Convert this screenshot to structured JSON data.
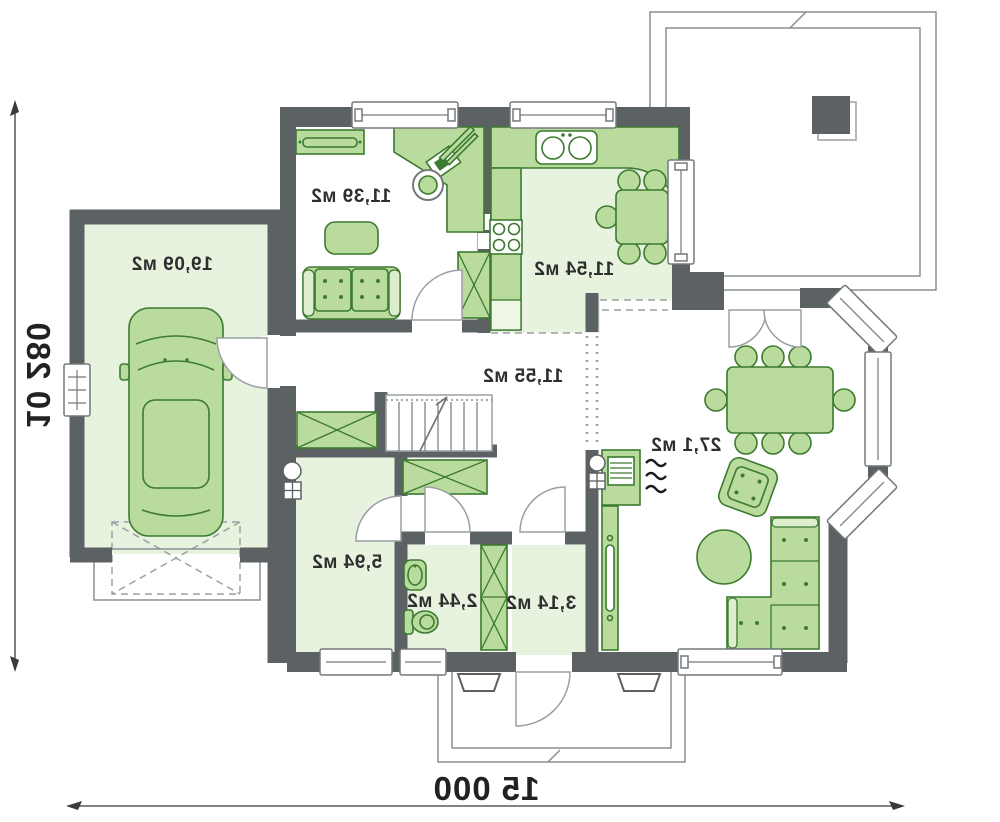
{
  "plan_type": "house-first-floor-plan",
  "note": "plan rendered mirrored (flipped horizontally), labels appear reversed",
  "rooms": [
    {
      "id": "garage",
      "area_label": "19,09 м2"
    },
    {
      "id": "office",
      "area_label": "11,39 м2"
    },
    {
      "id": "kitchen",
      "area_label": "11,54 м2"
    },
    {
      "id": "hallway",
      "area_label": "11,55 м2"
    },
    {
      "id": "living-room",
      "area_label": "27,1 м2"
    },
    {
      "id": "utility-room",
      "area_label": "5,94 м2"
    },
    {
      "id": "wc",
      "area_label": "2,44 м2"
    },
    {
      "id": "entry-hall",
      "area_label": "3,14 м2"
    }
  ],
  "dimensions": {
    "width_label": "15 000",
    "height_label": "10 280"
  },
  "colors": {
    "wall": "#5c6164",
    "room": "#e7f2df",
    "furniture": "#b9dc9e",
    "furniture_stroke": "#3c7a2f",
    "outline": "#8a8f92",
    "text": "#2e2e2e"
  },
  "icons": {
    "car-icon": "top-view car in garage",
    "sofa-icon": "two-seat sofa",
    "corner-sofa-icon": "L-shaped corner sofa",
    "armchair-icon": "rotated armchair",
    "dining-table-icon": "table with eight chairs",
    "kitchen-table-icon": "table with five chairs",
    "desk-icon": "L-shaped desk with laptop",
    "stove-icon": "four-burner cooktop",
    "sink-icon": "double-bowl kitchen sink",
    "fireplace-icon": "stove with heat waves",
    "tv-stand-icon": "media sideboard",
    "stairs-icon": "staircase with up line",
    "wardrobe-icon": "crossed storage cabinet",
    "toilet-icon": "WC toilet",
    "washbasin-icon": "small basin",
    "chimney-icon": "flue circle and vent grid",
    "rug-icon": "round rug"
  }
}
